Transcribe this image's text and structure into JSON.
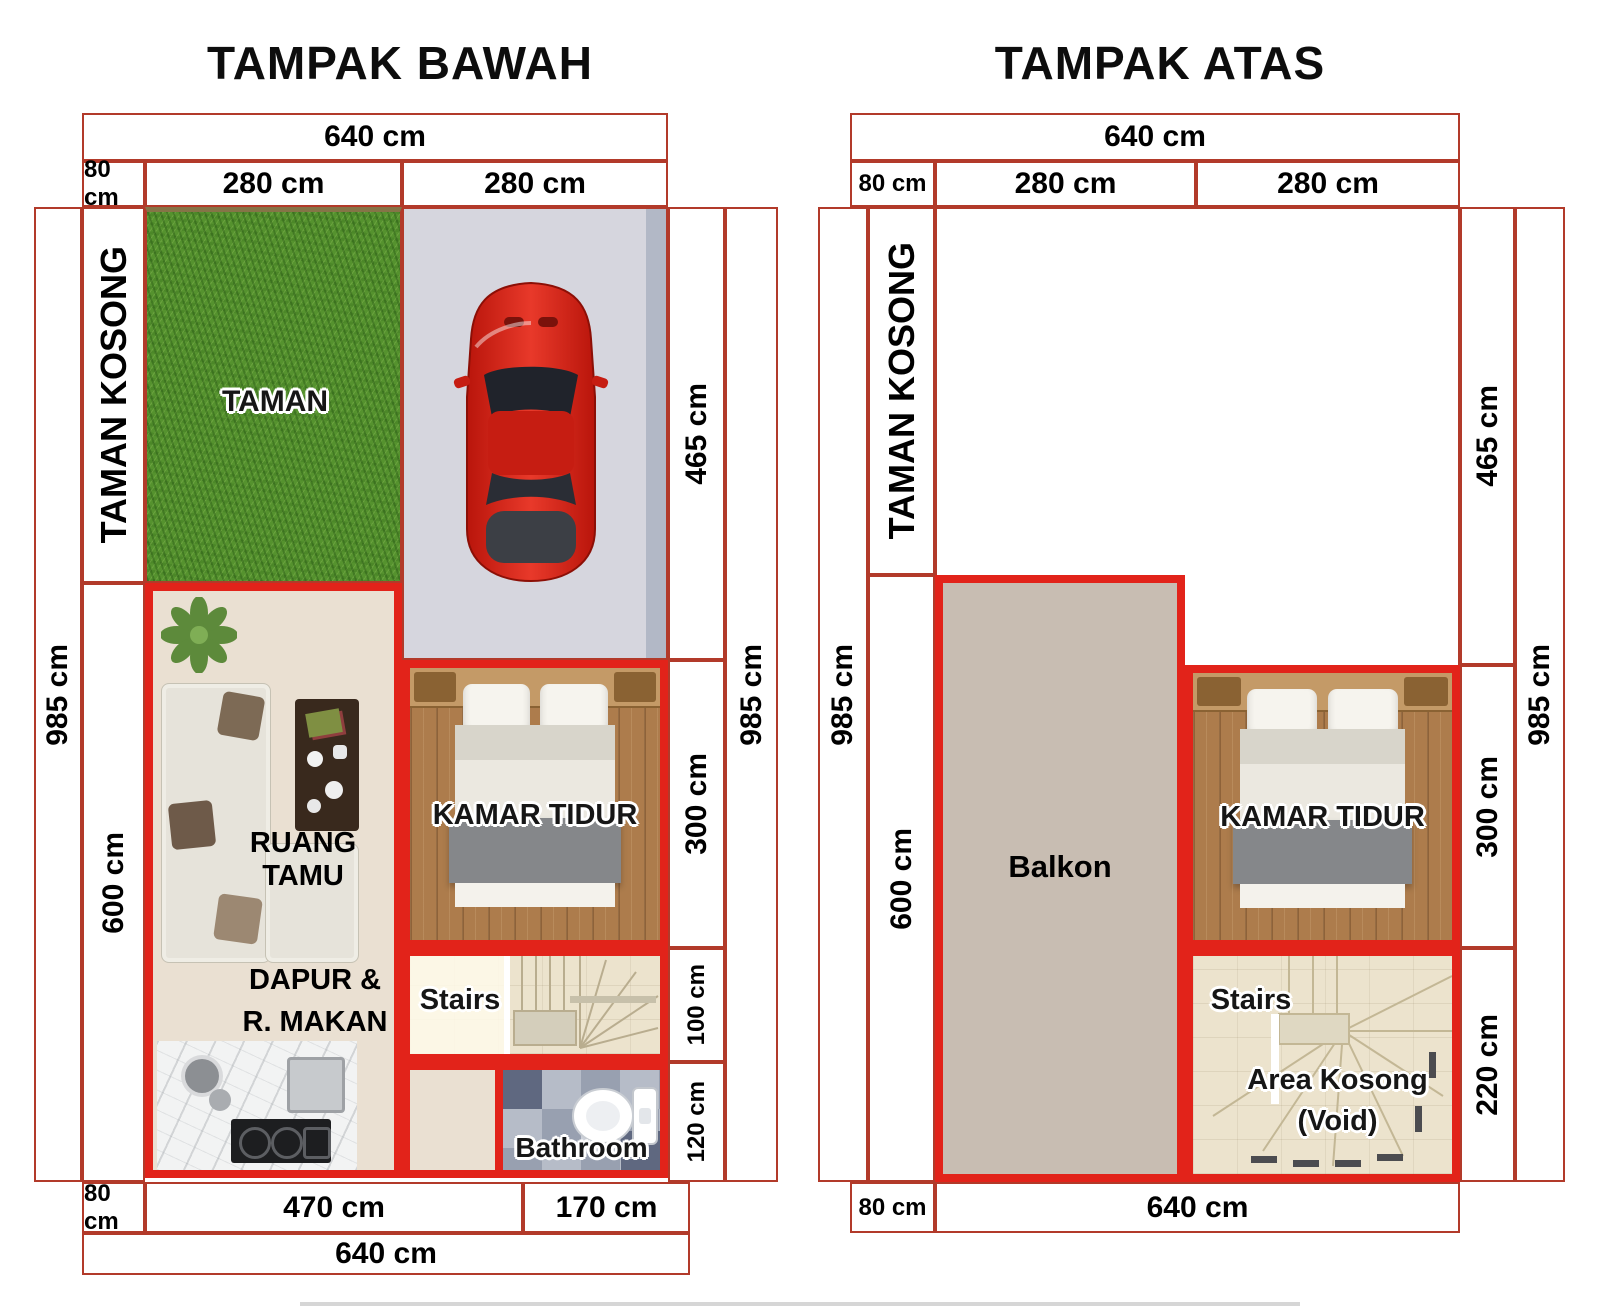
{
  "colors": {
    "dim_line": "#b23a2a",
    "wall_red": "#e2231a",
    "grass_green": "#55922e",
    "carport_gray": "#d6d6de",
    "floor_beige": "#eae0d2",
    "wood_brown": "#ad7c4c",
    "balkon_taupe": "#c8bdb2",
    "stone_cream": "#ece3cd",
    "car_red": "#d0231a"
  },
  "plan_bawah": {
    "title": "TAMPAK BAWAH",
    "top": {
      "total": "640 cm",
      "left": "80 cm",
      "mid": "280 cm",
      "right": "280 cm"
    },
    "left_col": {
      "outer": "985 cm",
      "strip": "TAMAN KOSONG",
      "lower": "600 cm"
    },
    "right_col": {
      "seg1": "465 cm",
      "seg2": "300 cm",
      "seg3": "100 cm",
      "seg4": "120 cm",
      "outer": "985 cm"
    },
    "bottom": {
      "left": "80 cm",
      "mid": "470 cm",
      "right": "170 cm",
      "total": "640 cm"
    },
    "rooms": {
      "taman": "TAMAN",
      "ruang_tamu": "RUANG TAMU",
      "kamar_tidur": "KAMAR TIDUR",
      "stairs": "Stairs",
      "dapur_line1": "DAPUR &",
      "dapur_line2": "R. MAKAN",
      "bathroom": "Bathroom"
    }
  },
  "plan_atas": {
    "title": "TAMPAK ATAS",
    "top": {
      "total": "640 cm",
      "left": "80 cm",
      "mid": "280 cm",
      "right": "280 cm"
    },
    "left_col": {
      "outer": "985 cm",
      "strip": "TAMAN KOSONG",
      "lower": "600 cm"
    },
    "right_col": {
      "seg1": "465 cm",
      "seg2": "300 cm",
      "seg3": "220 cm",
      "outer": "985 cm"
    },
    "bottom": {
      "left": "80 cm",
      "total": "640 cm"
    },
    "rooms": {
      "balkon": "Balkon",
      "kamar_tidur": "KAMAR TIDUR",
      "stairs": "Stairs",
      "void_line1": "Area Kosong",
      "void_line2": "(Void)"
    }
  }
}
